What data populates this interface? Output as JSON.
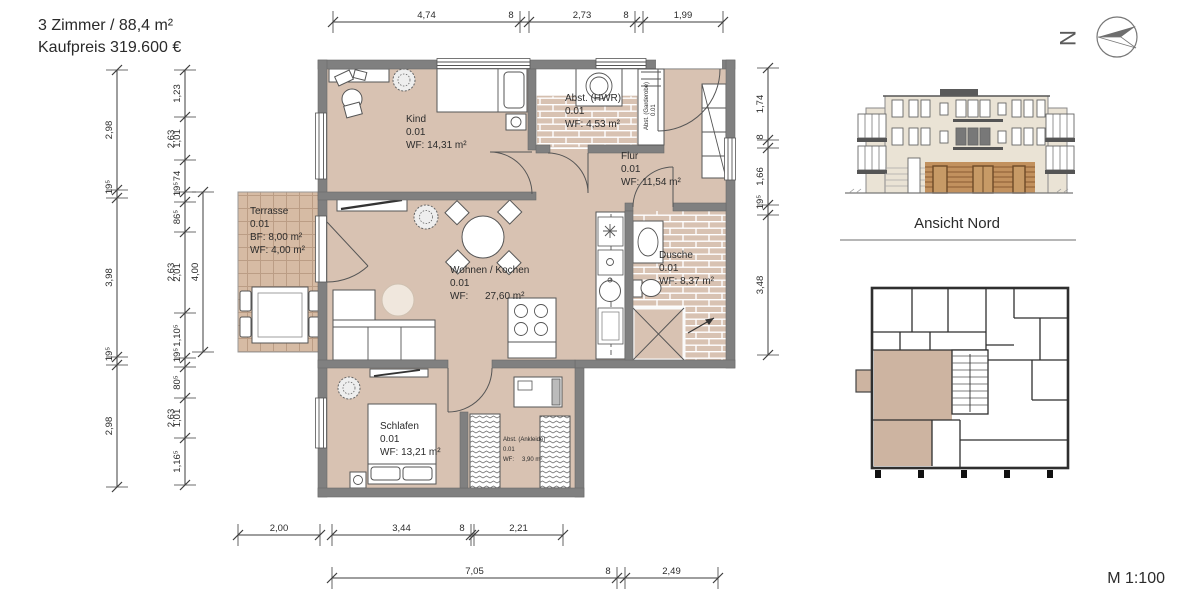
{
  "title": {
    "line1": "3 Zimmer   /   88,4 m²",
    "line2": "Kaufpreis 319.600 €"
  },
  "north_label": "N",
  "elevation_title": "Ansicht Nord",
  "scale_label": "M 1:100",
  "colors": {
    "wall": "#808080",
    "room_fill": "#d8c2b2",
    "terrace_fill": "#d6bba4",
    "facade": "#eae3d5",
    "highlight": "#c2915e",
    "overview_highlight": "#cdb4a1"
  },
  "rooms": {
    "kind": {
      "name": "Kind",
      "unit": "0.01",
      "area": "WF: 14,31 m²"
    },
    "hwr": {
      "name": "Abst. (HWR)",
      "unit": "0.01",
      "area": "WF: 4,53 m²"
    },
    "garderobe": {
      "name": "Abst. (Garderobe)",
      "unit": "0.01"
    },
    "flur": {
      "name": "Flur",
      "unit": "0.01",
      "area": "WF: 11,54 m²"
    },
    "terrasse": {
      "name": "Terrasse",
      "unit": "0.01",
      "bf": "BF: 8,00 m²",
      "wf": "WF: 4,00 m²"
    },
    "wohnen": {
      "name": "Wohnen / Kochen",
      "unit": "0.01",
      "area_label": "WF:",
      "area_value": "27,60 m²"
    },
    "dusche": {
      "name": "Dusche",
      "unit": "0.01",
      "area": "WF: 8,37 m²"
    },
    "schlafen": {
      "name": "Schlafen",
      "unit": "0.01",
      "area": "WF: 13,21 m²"
    },
    "ankleide": {
      "name": "Abst. (Ankleide)",
      "unit": "0.01",
      "area_label": "WF:",
      "area_value": "3,90 m²"
    }
  },
  "dimensions": {
    "top": [
      "4,74",
      "8",
      "2,73",
      "8",
      "1,99"
    ],
    "left_outer": [
      "2,98",
      "19⁵",
      "3,98",
      "19⁵",
      "2,98"
    ],
    "left_inner": [
      "1,23",
      "1,01",
      "74",
      "19⁵",
      "86⁵",
      "2,01",
      "1,10⁵",
      "19⁵",
      "80⁵",
      "1,01",
      "1,16⁵"
    ],
    "left_inner_secondary": [
      "2,63",
      "2,63",
      "2,63"
    ],
    "terrace": [
      "4,00"
    ],
    "right": [
      "1,74",
      "8",
      "1,66",
      "19⁵",
      "3,48"
    ],
    "bottom_upper_a": [
      "2,00"
    ],
    "bottom_upper_b": [
      "3,44",
      "8",
      "2,21"
    ],
    "bottom_lower": [
      "7,05",
      "8",
      "2,49"
    ]
  }
}
